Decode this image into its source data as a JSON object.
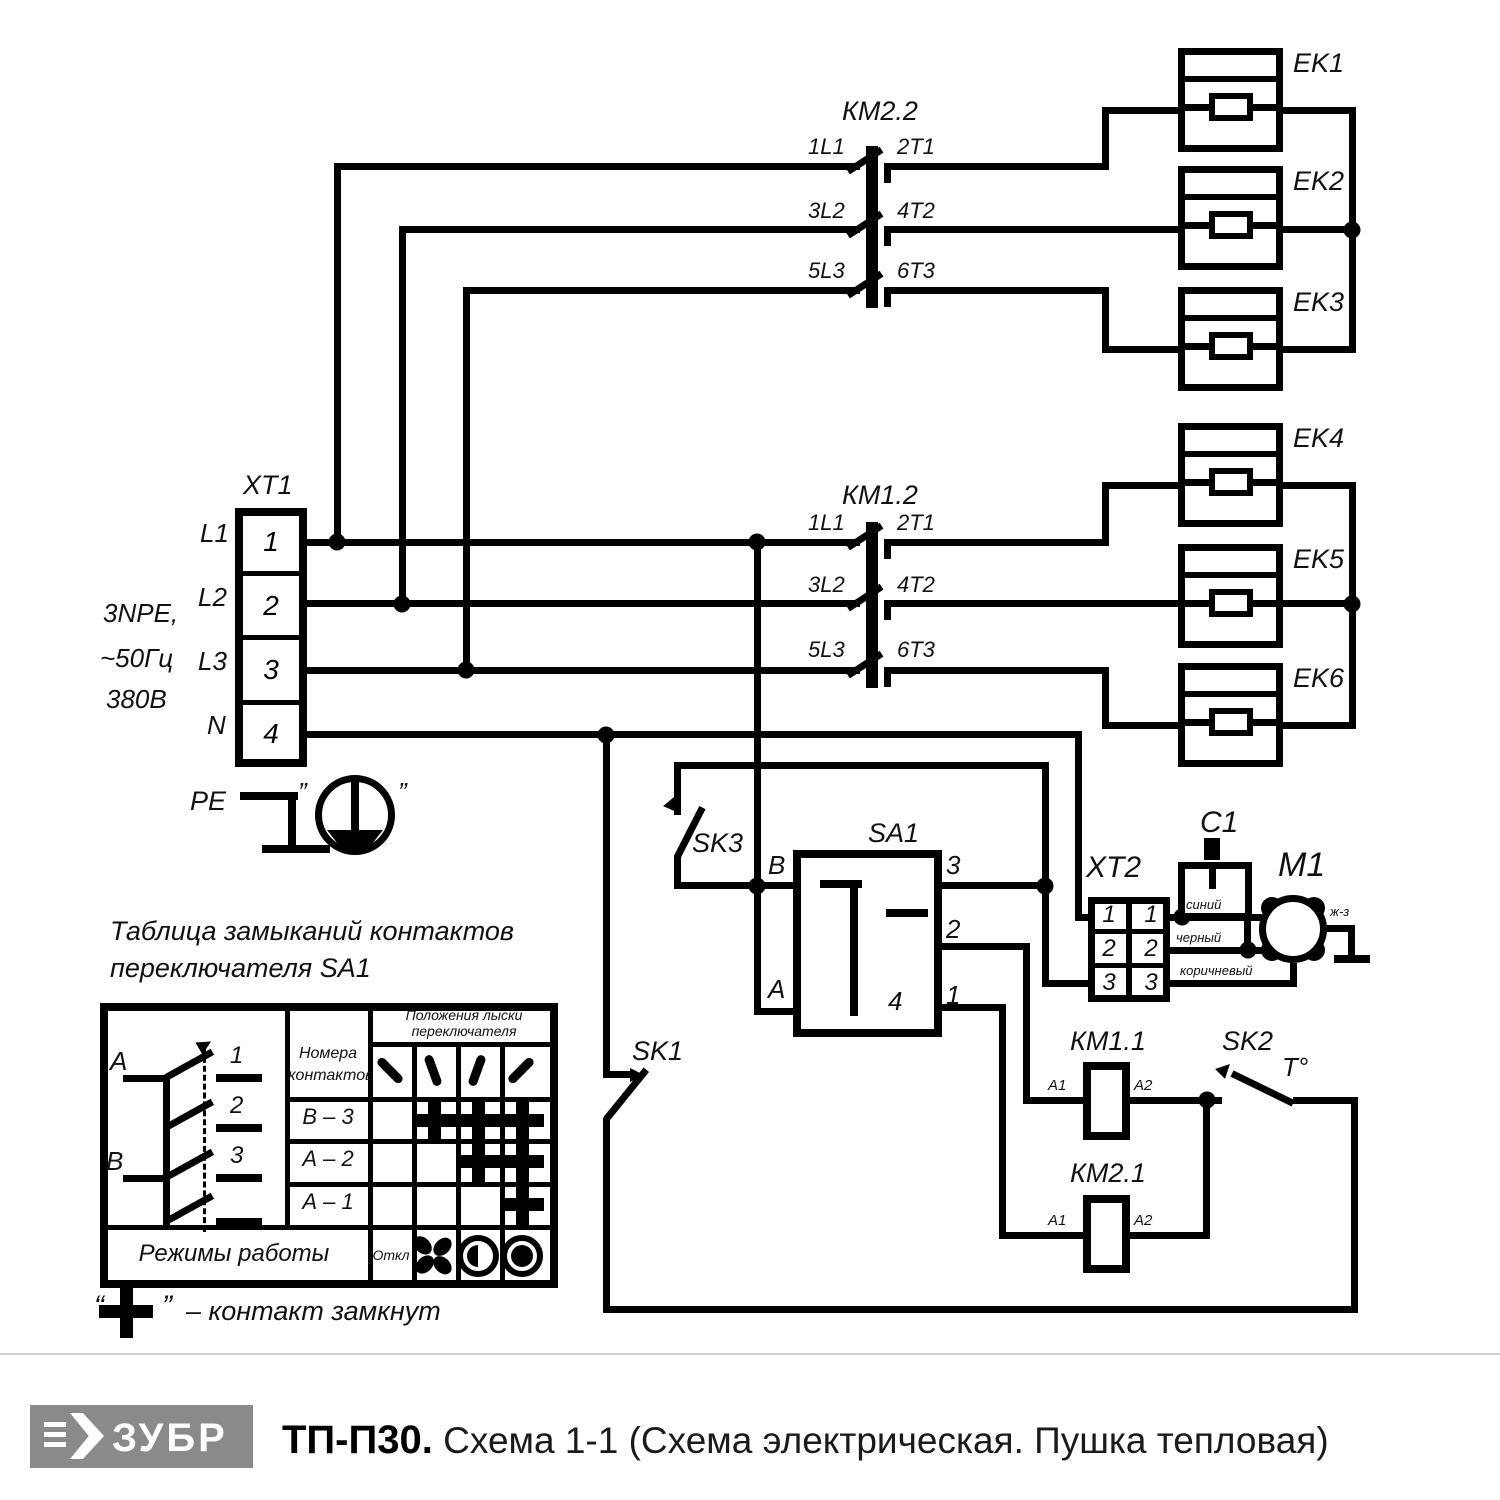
{
  "schematic": {
    "xt1": {
      "title": "XT1",
      "cells": [
        "1",
        "2",
        "3",
        "4"
      ],
      "phases": [
        "L1",
        "L2",
        "L3",
        "N"
      ]
    },
    "supply": [
      "3NPE,",
      "~50Гц",
      "380В"
    ],
    "pe": {
      "label": "PE",
      "quote_l": "”",
      "quote_r": "”"
    },
    "km22": {
      "title": "КМ2.2",
      "in": [
        "1L1",
        "3L2",
        "5L3"
      ],
      "out": [
        "2T1",
        "4T2",
        "6T3"
      ]
    },
    "km12": {
      "title": "КМ1.2",
      "in": [
        "1L1",
        "3L2",
        "5L3"
      ],
      "out": [
        "2T1",
        "4T2",
        "6T3"
      ]
    },
    "ek": [
      "EK1",
      "EK2",
      "EK3",
      "EK4",
      "EK5",
      "EK6"
    ],
    "sk1": "SK1",
    "sk2": "SK2",
    "sk2_t": "Т°",
    "sk3": "SK3",
    "sa1": {
      "title": "SA1",
      "b": "B",
      "a": "A",
      "t3": "3",
      "t2": "2",
      "t1": "1",
      "t4": "4"
    },
    "xt2": {
      "title": "XT2",
      "rows": [
        "1",
        "2",
        "3"
      ],
      "wires": [
        "синий",
        "черный",
        "коричневый"
      ]
    },
    "c1": "C1",
    "m1": "М1",
    "ground_wire": "ж-з",
    "km11": {
      "title": "КМ1.1",
      "a1": "А1",
      "a2": "А2"
    },
    "km21": {
      "title": "КМ2.1",
      "a1": "А1",
      "a2": "А2"
    }
  },
  "table": {
    "title_line1": "Таблица замыканий контактов",
    "title_line2": "переключателя SA1",
    "col_numbers_l1": "Номера",
    "col_numbers_l2": "контактов",
    "col_positions_l1": "Положения лыски",
    "col_positions_l2": "переключателя",
    "rows": [
      {
        "label": "В – 3",
        "marks": [
          false,
          true,
          true,
          true
        ]
      },
      {
        "label": "А – 2",
        "marks": [
          false,
          false,
          true,
          true
        ]
      },
      {
        "label": "А – 1",
        "marks": [
          false,
          false,
          false,
          true
        ]
      }
    ],
    "modes_label": "Режимы работы",
    "off_label": "Откл",
    "diagram": {
      "a": "А",
      "b": "В",
      "c1": "1",
      "c2": "2",
      "c3": "3"
    },
    "legend_quote_l": "“",
    "legend_quote_r": "”",
    "legend_text": "– контакт замкнут"
  },
  "footer": {
    "brand": "ЗУБР",
    "model": "ТП-П30.",
    "description": "Схема 1-1 (Схема электрическая. Пушка тепловая)",
    "logo_bg": "#8a8a8a"
  }
}
